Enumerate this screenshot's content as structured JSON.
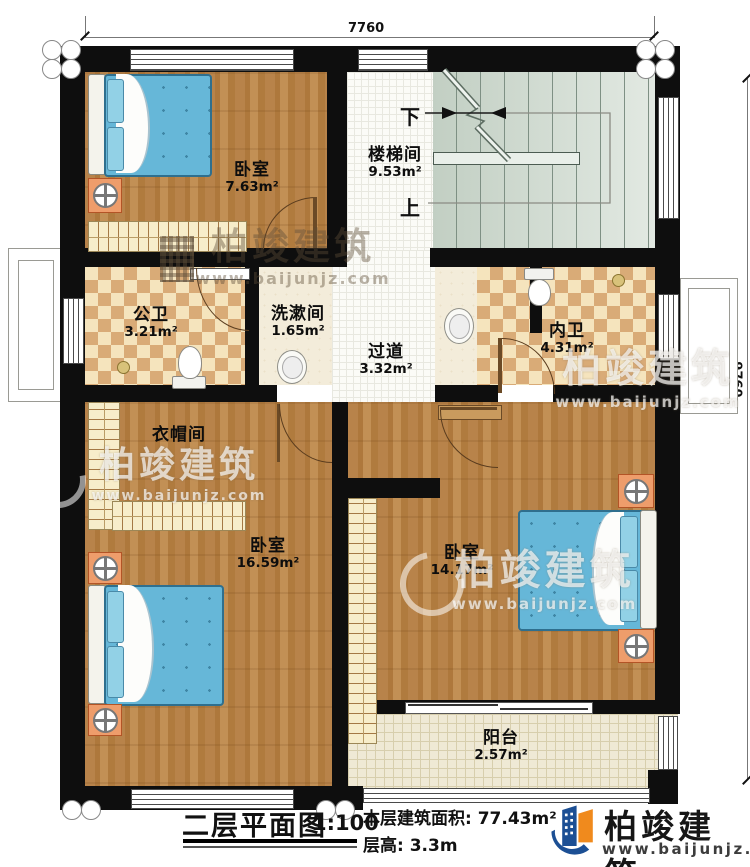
{
  "dimensions": {
    "top": "7760",
    "right": "9760"
  },
  "rooms": {
    "bedroom_top": {
      "name": "卧室",
      "area": "7.63m²"
    },
    "stairwell": {
      "name": "楼梯间",
      "area": "9.53m²",
      "down_label": "下",
      "up_label": "上"
    },
    "public_bath": {
      "name": "公卫",
      "area": "3.21m²"
    },
    "washroom": {
      "name": "洗漱间",
      "area": "1.65m²"
    },
    "hallway": {
      "name": "过道",
      "area": "3.32m²"
    },
    "ensuite_bath": {
      "name": "内卫",
      "area": "4.31m²"
    },
    "cloakroom": {
      "name": "衣帽间"
    },
    "bedroom_left": {
      "name": "卧室",
      "area": "16.59m²"
    },
    "bedroom_right": {
      "name": "卧室",
      "area": "14.17m²"
    },
    "balcony": {
      "name": "阳台",
      "area": "2.57m²"
    }
  },
  "footer": {
    "title": "二层平面图",
    "scale": "1:100",
    "floor_area": "本层建筑面积: 77.43m²",
    "floor_height": "层高: 3.3m"
  },
  "brand": {
    "name": "柏竣建筑",
    "website": "www.baijunjz.com",
    "blue": "#1c4f94",
    "orange": "#f08a1d"
  }
}
